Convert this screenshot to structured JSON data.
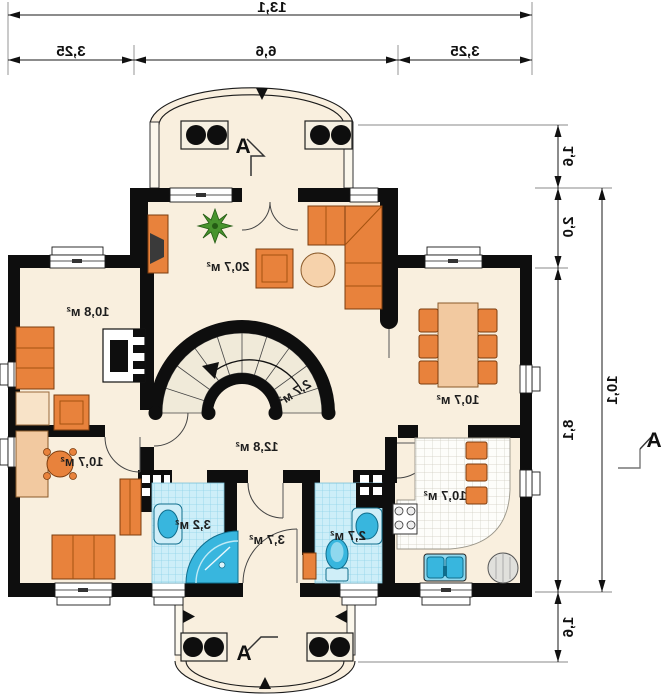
{
  "dimensions": {
    "top": {
      "total": "13,1",
      "segments": [
        "3,25",
        "6,6",
        "3,25"
      ]
    },
    "right": {
      "total": "10,1",
      "segments": [
        "1,6",
        "2,0",
        "8,1",
        "1,6"
      ]
    }
  },
  "section_markers": {
    "top": "A",
    "bottom": "A",
    "right": "A"
  },
  "rooms": {
    "living": {
      "area": "20,7 м²"
    },
    "room_upper_left": {
      "area": "10,8 м²"
    },
    "dining": {
      "area": "10,7 м²"
    },
    "hall": {
      "area": "12,8 м²"
    },
    "stair_closet": {
      "area": "2,7 м²"
    },
    "office": {
      "area": "10,7 м²"
    },
    "bathroom": {
      "area": "3,2 м²"
    },
    "vestibule": {
      "area": "3,7 м²"
    },
    "wc": {
      "area": "2,7 м²"
    },
    "kitchen": {
      "area": "10,7 м²"
    }
  },
  "colors": {
    "wall": "#0e0e0e",
    "floor": "#f9efde",
    "orange": "#e8823c",
    "orange_dark": "#a4520f",
    "wood": "#f2c9a0",
    "tile_blue": "#cdeef8",
    "tile_grid": "#8fd3e8",
    "fixture": "#38b6de",
    "fixture_light": "#cfeef8",
    "plant": "#48942e",
    "stair_tread": "#f0ead9"
  }
}
